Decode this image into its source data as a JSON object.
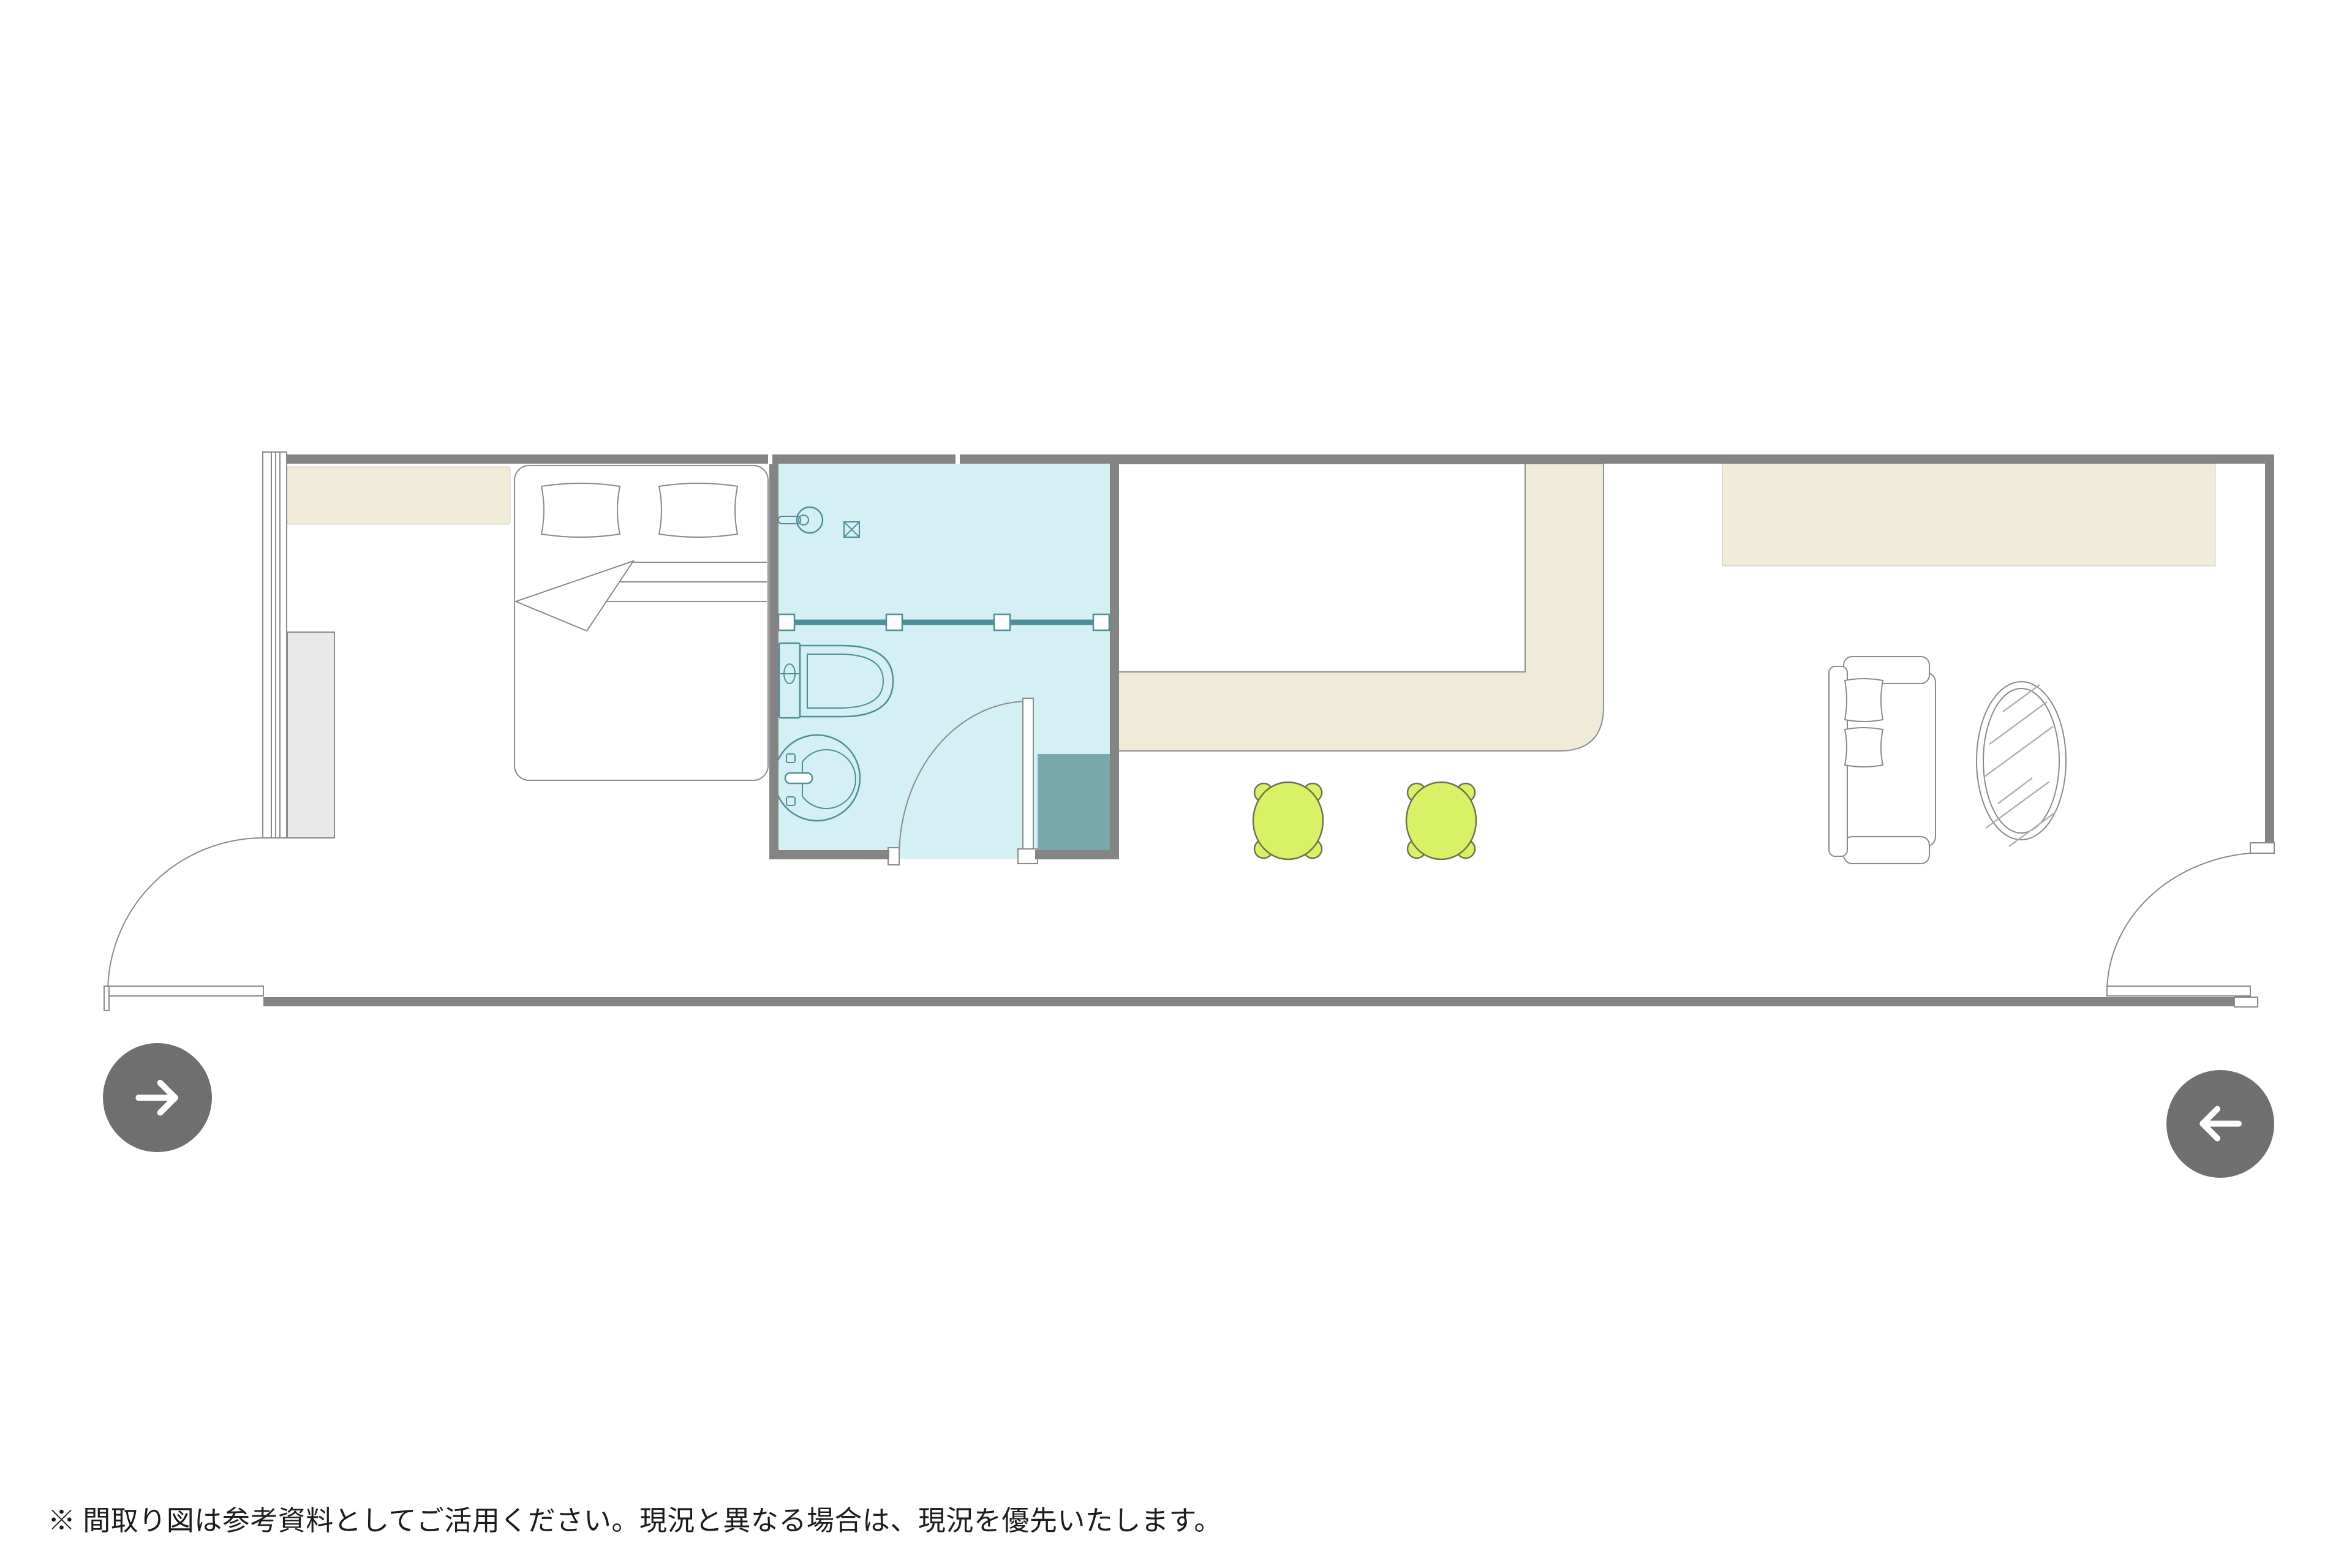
{
  "footer": {
    "note": "※ 間取り図は参考資料としてご活用ください。現況と異なる場合は、現況を優先いたします。"
  },
  "nav": {
    "forward": {
      "icon": "right-arrow-icon",
      "label": "next"
    },
    "back": {
      "icon": "left-arrow-icon",
      "label": "previous"
    }
  },
  "floor_plan": {
    "rooms": [
      "bedroom",
      "bathroom",
      "kitchen",
      "living-area"
    ],
    "fixtures": {
      "bedroom": [
        "window",
        "counter-shelf",
        "double-bed",
        "pillow",
        "pillow",
        "closet"
      ],
      "bathroom": [
        "shower-head",
        "floor-drain",
        "shower-partition",
        "toilet",
        "wash-basin",
        "swing-door",
        "utility-block"
      ],
      "kitchen": [
        "l-shaped-counter",
        "stool",
        "stool"
      ],
      "living-area": [
        "wall-shelf",
        "sofa",
        "oval-mirror"
      ],
      "entry_doors": 2
    }
  },
  "colors": {
    "wall": "#848484",
    "bathroom_floor": "#d5f0f4",
    "bathroom_line": "#4d8f98",
    "utility_block": "#7aa9ad",
    "counter_beige": "#f0ebd8",
    "counter_line": "#8f8f8f",
    "shelf_beige": "#f1ecd9",
    "stool_green": "#d8f165",
    "stool_line": "#6f7152",
    "furniture_line": "#8a8a8a",
    "closet_fill": "#e9e9e9",
    "mirror_hatch": "#aab4b4",
    "button_bg": "#6f6f6f",
    "button_arrow": "#ffffff",
    "text": "#1c1c1c"
  }
}
